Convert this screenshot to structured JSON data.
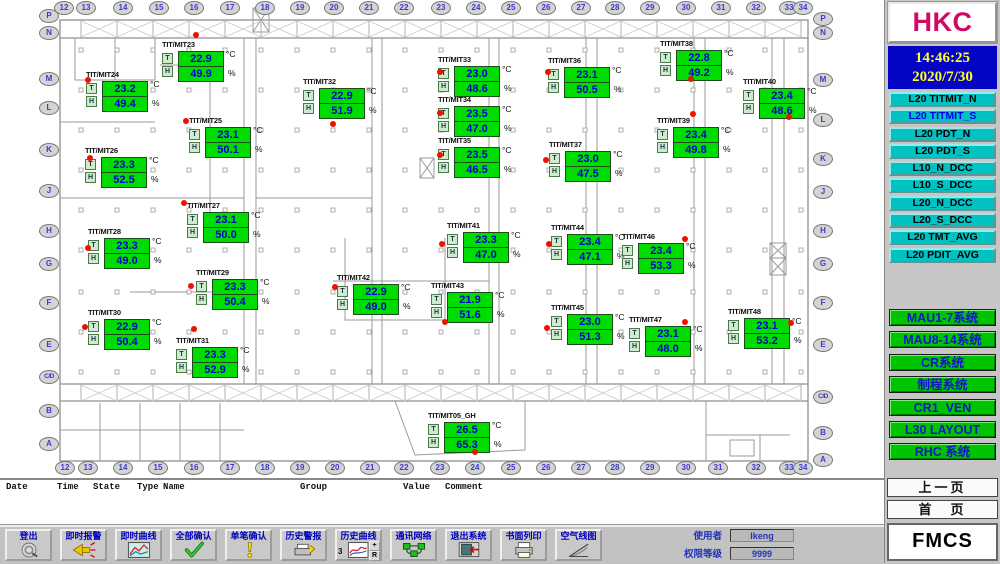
{
  "right_panel": {
    "logo": "HKC",
    "clock": {
      "time": "14:46:25",
      "date": "2020/7/30"
    },
    "nav_buttons": [
      {
        "label": "L20 TITMIT_N",
        "active": false
      },
      {
        "label": "L20 TITMIT_S",
        "active": true
      },
      {
        "label": "L20 PDT_N",
        "active": false
      },
      {
        "label": "L20 PDT_S",
        "active": false
      },
      {
        "label": "L10_N_DCC",
        "active": false
      },
      {
        "label": "L10_S_DCC",
        "active": false
      },
      {
        "label": "L20_N_DCC",
        "active": false
      },
      {
        "label": "L20_S_DCC",
        "active": false
      },
      {
        "label": "L20 TMT_AVG",
        "active": false
      },
      {
        "label": "L20 PDIT_AVG",
        "active": false
      }
    ],
    "system_buttons": [
      "MAU1-7系统",
      "MAU8-14系统",
      "CR系统",
      "制程系统",
      "CR1_VEN",
      "L30 LAYOUT",
      "RHC 系统"
    ],
    "page_buttons": [
      "上一页",
      "首　页"
    ],
    "app_name": "FMCS"
  },
  "alarm_list": {
    "columns": [
      {
        "label": "Date",
        "x": 6
      },
      {
        "label": "Time",
        "x": 57
      },
      {
        "label": "State",
        "x": 93
      },
      {
        "label": "Type",
        "x": 137
      },
      {
        "label": "Name",
        "x": 163
      },
      {
        "label": "Group",
        "x": 300
      },
      {
        "label": "Value",
        "x": 403
      },
      {
        "label": "Comment",
        "x": 445
      }
    ]
  },
  "toolbar": {
    "buttons": [
      {
        "label": "登出",
        "name": "logout",
        "icon": "logout-icon"
      },
      {
        "label": "即时报警",
        "name": "realtime-alarm",
        "icon": "alarm-icon"
      },
      {
        "label": "即时曲线",
        "name": "realtime-trend",
        "icon": "trend-icon"
      },
      {
        "label": "全部确认",
        "name": "ack-all",
        "icon": "ack-all-icon"
      },
      {
        "label": "单笔确认",
        "name": "ack-single",
        "icon": "ack-one-icon"
      },
      {
        "label": "历史警报",
        "name": "history-alarm",
        "icon": "history-alarm-icon"
      },
      {
        "label": "历史曲线",
        "name": "history-trend",
        "icon": "history-trend-icon",
        "extras": {
          "prefix": "3",
          "mini": [
            "+",
            "R"
          ]
        }
      },
      {
        "label": "通讯网络",
        "name": "comm-network",
        "icon": "network-icon"
      },
      {
        "label": "退出系统",
        "name": "exit-system",
        "icon": "exit-icon"
      },
      {
        "label": "书面列印",
        "name": "print",
        "icon": "print-icon"
      },
      {
        "label": "空气线图",
        "name": "psychrometric",
        "icon": "psychro-icon"
      }
    ],
    "user_label": "使用者",
    "user_value": "lkeng",
    "level_label": "权限等级",
    "level_value": "9999"
  },
  "floor_plan": {
    "units": {
      "temp": "°C",
      "rh": "%"
    },
    "colors": {
      "sensor_green": "#00dc00",
      "value_blue": "#0000cc",
      "alarm_red": "#ee1100",
      "nav_teal": "#00c2c2",
      "system_green": "#00c400",
      "clock_bg": "#0404c4",
      "clock_text": "#ffff2e",
      "logo_magenta": "#cf0a64"
    },
    "grid_top": [
      {
        "label": "12",
        "x": 64
      },
      {
        "label": "13",
        "x": 86
      },
      {
        "label": "14",
        "x": 123
      },
      {
        "label": "15",
        "x": 159
      },
      {
        "label": "16",
        "x": 194
      },
      {
        "label": "17",
        "x": 230
      },
      {
        "label": "18",
        "x": 265
      },
      {
        "label": "19",
        "x": 300
      },
      {
        "label": "20",
        "x": 334
      },
      {
        "label": "21",
        "x": 369
      },
      {
        "label": "22",
        "x": 404
      },
      {
        "label": "23",
        "x": 441
      },
      {
        "label": "24",
        "x": 476
      },
      {
        "label": "25",
        "x": 511
      },
      {
        "label": "26",
        "x": 546
      },
      {
        "label": "27",
        "x": 581
      },
      {
        "label": "28",
        "x": 615
      },
      {
        "label": "29",
        "x": 650
      },
      {
        "label": "30",
        "x": 686
      },
      {
        "label": "31",
        "x": 721
      },
      {
        "label": "32",
        "x": 756
      },
      {
        "label": "33",
        "x": 789
      },
      {
        "label": "34",
        "x": 803
      }
    ],
    "grid_bottom": [
      {
        "label": "12",
        "x": 65
      },
      {
        "label": "13",
        "x": 88
      },
      {
        "label": "14",
        "x": 123
      },
      {
        "label": "15",
        "x": 158
      },
      {
        "label": "16",
        "x": 194
      },
      {
        "label": "17",
        "x": 230
      },
      {
        "label": "18",
        "x": 265
      },
      {
        "label": "19",
        "x": 300
      },
      {
        "label": "20",
        "x": 335
      },
      {
        "label": "21",
        "x": 370
      },
      {
        "label": "22",
        "x": 404
      },
      {
        "label": "23",
        "x": 440
      },
      {
        "label": "24",
        "x": 475
      },
      {
        "label": "25",
        "x": 511
      },
      {
        "label": "26",
        "x": 546
      },
      {
        "label": "27",
        "x": 581
      },
      {
        "label": "28",
        "x": 615
      },
      {
        "label": "29",
        "x": 650
      },
      {
        "label": "30",
        "x": 686
      },
      {
        "label": "31",
        "x": 718
      },
      {
        "label": "32",
        "x": 756
      },
      {
        "label": "33",
        "x": 789
      },
      {
        "label": "34",
        "x": 803
      }
    ],
    "grid_left": [
      {
        "label": "P",
        "y": 16
      },
      {
        "label": "N",
        "y": 33
      },
      {
        "label": "M",
        "y": 79
      },
      {
        "label": "L",
        "y": 108
      },
      {
        "label": "K",
        "y": 150
      },
      {
        "label": "J",
        "y": 191
      },
      {
        "label": "H",
        "y": 231
      },
      {
        "label": "G",
        "y": 264
      },
      {
        "label": "F",
        "y": 303
      },
      {
        "label": "E",
        "y": 345
      },
      {
        "label": "C/D",
        "y": 377
      },
      {
        "label": "B",
        "y": 411
      },
      {
        "label": "A",
        "y": 444
      }
    ],
    "grid_right": [
      {
        "label": "P",
        "y": 19
      },
      {
        "label": "N",
        "y": 33
      },
      {
        "label": "M",
        "y": 80
      },
      {
        "label": "L",
        "y": 120
      },
      {
        "label": "K",
        "y": 159
      },
      {
        "label": "J",
        "y": 192
      },
      {
        "label": "H",
        "y": 231
      },
      {
        "label": "G",
        "y": 264
      },
      {
        "label": "F",
        "y": 303
      },
      {
        "label": "E",
        "y": 345
      },
      {
        "label": "C/D",
        "y": 397
      },
      {
        "label": "B",
        "y": 433
      },
      {
        "label": "A",
        "y": 460
      }
    ],
    "sensors": [
      {
        "name": "TIT/MIT23",
        "temp": "22.9",
        "rh": "49.9",
        "x": 178,
        "y": 51,
        "dot": {
          "x": 196,
          "y": 35
        }
      },
      {
        "name": "TIT/MIT24",
        "temp": "23.2",
        "rh": "49.4",
        "x": 102,
        "y": 81,
        "dot": {
          "x": 88,
          "y": 80
        }
      },
      {
        "name": "TIT/MIT25",
        "temp": "23.1",
        "rh": "50.1",
        "x": 205,
        "y": 127,
        "dot": {
          "x": 186,
          "y": 121
        }
      },
      {
        "name": "TIT/MIT26",
        "temp": "23.3",
        "rh": "52.5",
        "x": 101,
        "y": 157,
        "dot": {
          "x": 90,
          "y": 158
        }
      },
      {
        "name": "TIT/MIT27",
        "temp": "23.1",
        "rh": "50.0",
        "x": 203,
        "y": 212,
        "dot": {
          "x": 184,
          "y": 203
        }
      },
      {
        "name": "TIT/MIT28",
        "temp": "23.3",
        "rh": "49.0",
        "x": 104,
        "y": 238,
        "dot": {
          "x": 88,
          "y": 248
        }
      },
      {
        "name": "TIT/MIT29",
        "temp": "23.3",
        "rh": "50.4",
        "x": 212,
        "y": 279,
        "dot": {
          "x": 191,
          "y": 286
        }
      },
      {
        "name": "TIT/MIT30",
        "temp": "22.9",
        "rh": "50.4",
        "x": 104,
        "y": 319,
        "dot": {
          "x": 85,
          "y": 327
        }
      },
      {
        "name": "TIT/MIT31",
        "temp": "23.3",
        "rh": "52.9",
        "x": 192,
        "y": 347,
        "dot": {
          "x": 194,
          "y": 329
        }
      },
      {
        "name": "TIT/MIT32",
        "temp": "22.9",
        "rh": "51.9",
        "x": 319,
        "y": 88,
        "dot": {
          "x": 333,
          "y": 124
        }
      },
      {
        "name": "TIT/MIT33",
        "temp": "23.0",
        "rh": "48.6",
        "x": 454,
        "y": 66,
        "dot": {
          "x": 440,
          "y": 72
        }
      },
      {
        "name": "TIT/MIT34",
        "temp": "23.5",
        "rh": "47.0",
        "x": 454,
        "y": 106,
        "dot": {
          "x": 440,
          "y": 113
        }
      },
      {
        "name": "TIT/MIT35",
        "temp": "23.5",
        "rh": "46.5",
        "x": 454,
        "y": 147,
        "dot": {
          "x": 440,
          "y": 155
        }
      },
      {
        "name": "TIT/MIT36",
        "temp": "23.1",
        "rh": "50.5",
        "x": 564,
        "y": 67,
        "dot": {
          "x": 548,
          "y": 72
        }
      },
      {
        "name": "TIT/MIT37",
        "temp": "23.0",
        "rh": "47.5",
        "x": 565,
        "y": 151,
        "dot": {
          "x": 546,
          "y": 160
        }
      },
      {
        "name": "TIT/MIT38",
        "temp": "22.8",
        "rh": "49.2",
        "x": 676,
        "y": 50,
        "dot": {
          "x": 691,
          "y": 79
        }
      },
      {
        "name": "TIT/MIT39",
        "temp": "23.4",
        "rh": "49.8",
        "x": 673,
        "y": 127,
        "dot": {
          "x": 693,
          "y": 114
        }
      },
      {
        "name": "TIT/MIT40",
        "temp": "23.4",
        "rh": "48.6",
        "x": 759,
        "y": 88,
        "dot": {
          "x": 789,
          "y": 117
        }
      },
      {
        "name": "TIT/MIT41",
        "temp": "23.3",
        "rh": "47.0",
        "x": 463,
        "y": 232,
        "dot": {
          "x": 442,
          "y": 244
        }
      },
      {
        "name": "TIT/MIT42",
        "temp": "22.9",
        "rh": "49.0",
        "x": 353,
        "y": 284,
        "dot": {
          "x": 335,
          "y": 287
        }
      },
      {
        "name": "TIT/MIT43",
        "temp": "21.9",
        "rh": "51.6",
        "x": 447,
        "y": 292,
        "dot": {
          "x": 445,
          "y": 322
        }
      },
      {
        "name": "TIT/MIT44",
        "temp": "23.4",
        "rh": "47.1",
        "x": 567,
        "y": 234,
        "dot": {
          "x": 549,
          "y": 244
        }
      },
      {
        "name": "TIT/MIT45",
        "temp": "23.0",
        "rh": "51.3",
        "x": 567,
        "y": 314,
        "dot": {
          "x": 547,
          "y": 328
        }
      },
      {
        "name": "TIT/MIT46",
        "temp": "23.4",
        "rh": "53.3",
        "x": 638,
        "y": 243,
        "dot": {
          "x": 685,
          "y": 239
        }
      },
      {
        "name": "TIT/MIT47",
        "temp": "23.1",
        "rh": "48.0",
        "x": 645,
        "y": 326,
        "dot": {
          "x": 685,
          "y": 322
        }
      },
      {
        "name": "TIT/MIT48",
        "temp": "23.1",
        "rh": "53.2",
        "x": 744,
        "y": 318,
        "dot": {
          "x": 791,
          "y": 323
        }
      },
      {
        "name": "TIT/MIT05_GH",
        "temp": "26.5",
        "rh": "65.3",
        "x": 444,
        "y": 422,
        "dot": {
          "x": 475,
          "y": 452
        }
      }
    ]
  }
}
